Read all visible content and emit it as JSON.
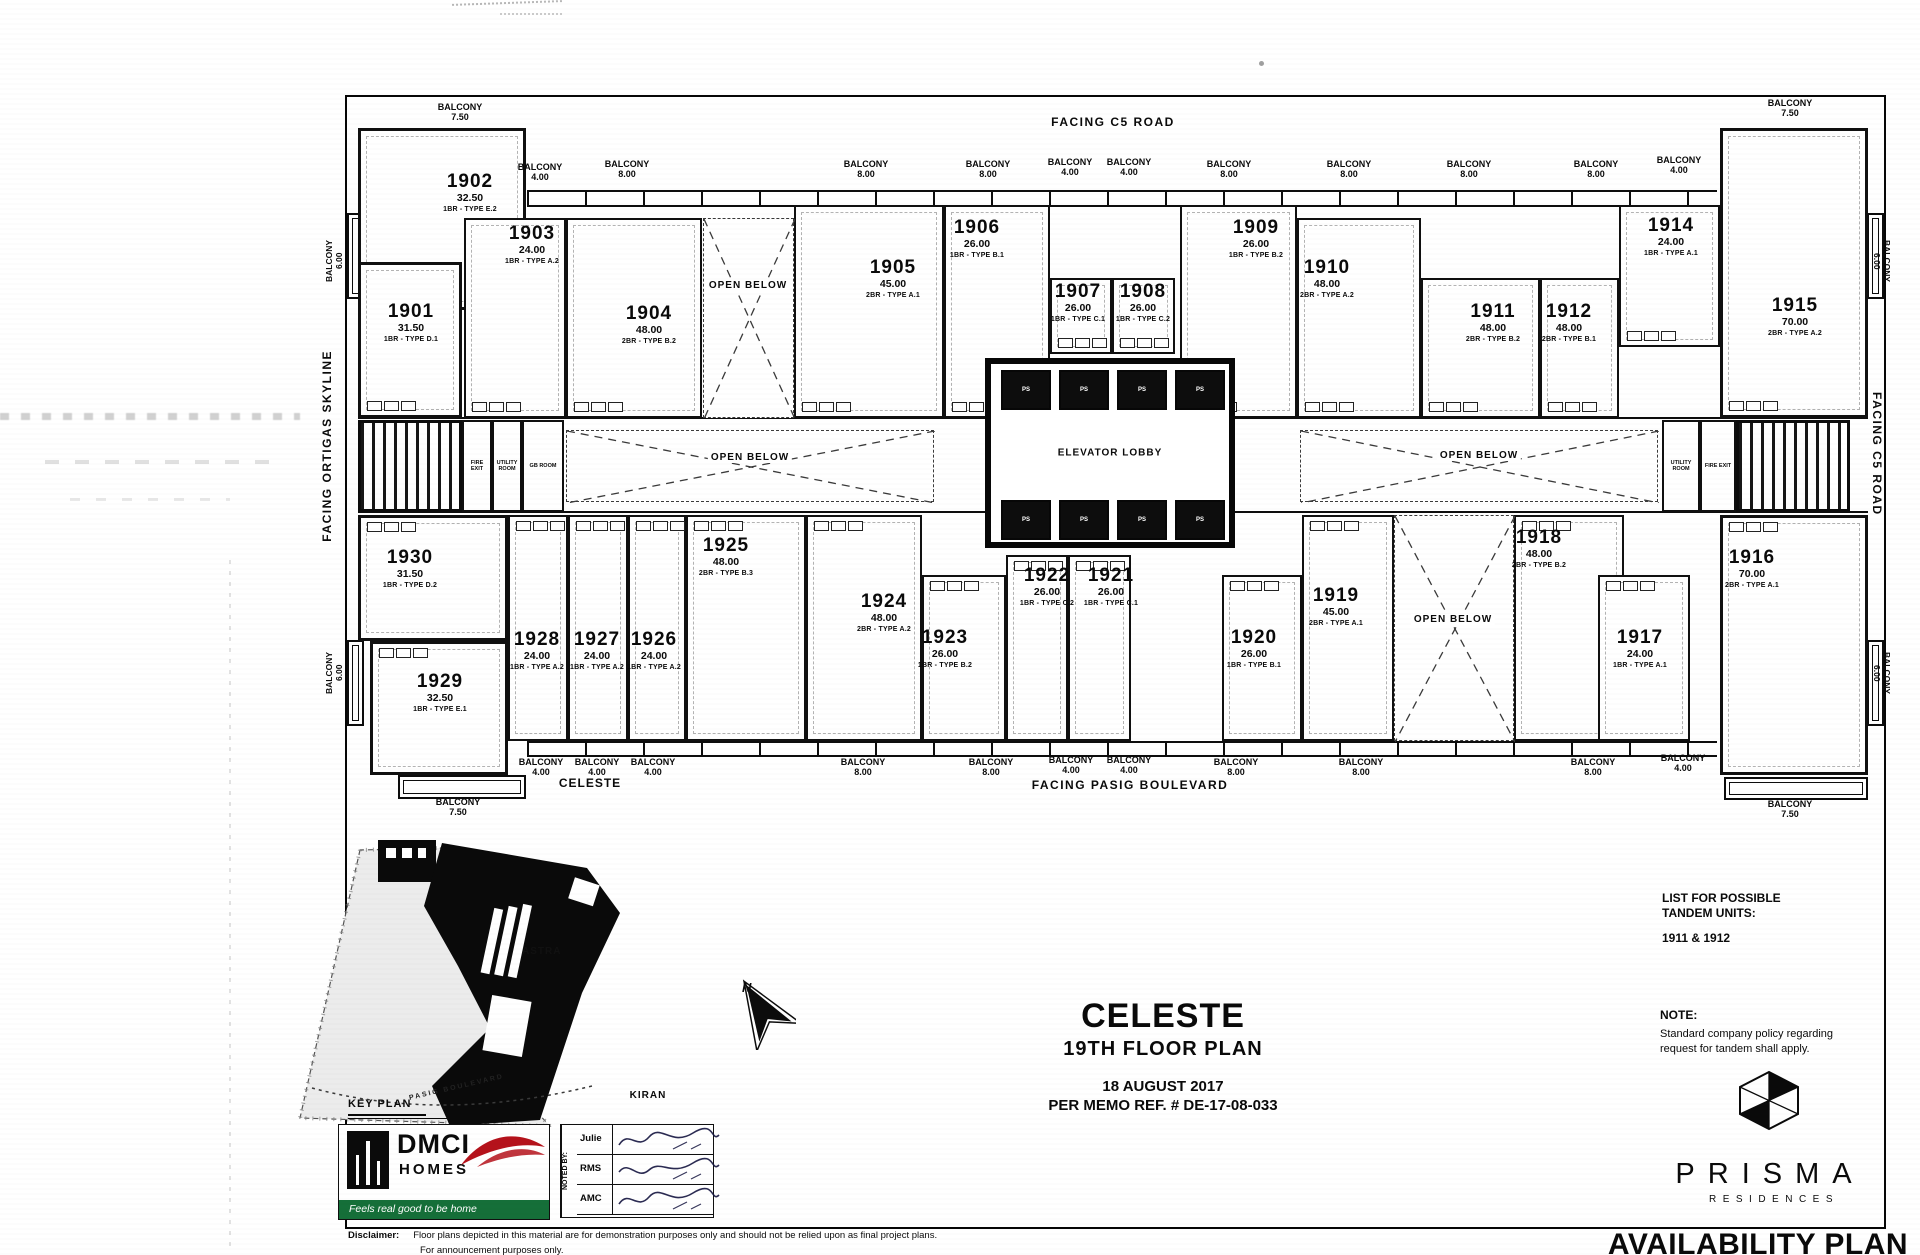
{
  "plan": {
    "facing_top": "FACING C5 ROAD",
    "facing_left": "FACING ORTIGAS SKYLINE",
    "facing_right": "FACING C5 ROAD",
    "facing_bottom": "FACING PASIG BOULEVARD",
    "elevator_label": "ELEVATOR LOBBY",
    "open_below_label": "OPEN BELOW",
    "balcony_word": "BALCONY",
    "car_label": "PS"
  },
  "units": [
    {
      "n": "1902",
      "a": "32.50",
      "t": "1BR - TYPE E.2",
      "x": 358,
      "y": 128,
      "w": 168,
      "h": 182,
      "lx": 470,
      "ly": 172,
      "corner": true
    },
    {
      "n": "1901",
      "a": "31.50",
      "t": "1BR - TYPE D.1",
      "x": 358,
      "y": 262,
      "w": 104,
      "h": 156,
      "lx": 411,
      "ly": 302,
      "corner": true
    },
    {
      "n": "1903",
      "a": "24.00",
      "t": "1BR - TYPE A.2",
      "x": 464,
      "y": 218,
      "w": 102,
      "h": 200,
      "lx": 532,
      "ly": 224
    },
    {
      "n": "1904",
      "a": "48.00",
      "t": "2BR - TYPE B.2",
      "x": 566,
      "y": 218,
      "w": 136,
      "h": 200,
      "lx": 649,
      "ly": 304
    },
    {
      "n": "1905",
      "a": "45.00",
      "t": "2BR - TYPE A.1",
      "x": 794,
      "y": 205,
      "w": 150,
      "h": 213,
      "lx": 893,
      "ly": 258
    },
    {
      "n": "1906",
      "a": "26.00",
      "t": "1BR - TYPE B.1",
      "x": 944,
      "y": 205,
      "w": 106,
      "h": 213,
      "lx": 977,
      "ly": 218
    },
    {
      "n": "1907",
      "a": "26.00",
      "t": "1BR - TYPE C.1",
      "x": 1050,
      "y": 278,
      "w": 62,
      "h": 76,
      "lx": 1078,
      "ly": 282
    },
    {
      "n": "1908",
      "a": "26.00",
      "t": "1BR - TYPE C.2",
      "x": 1112,
      "y": 278,
      "w": 63,
      "h": 76,
      "lx": 1143,
      "ly": 282
    },
    {
      "n": "1909",
      "a": "26.00",
      "t": "1BR - TYPE B.2",
      "x": 1180,
      "y": 205,
      "w": 117,
      "h": 213,
      "lx": 1256,
      "ly": 218
    },
    {
      "n": "1910",
      "a": "48.00",
      "t": "2BR - TYPE A.2",
      "x": 1297,
      "y": 218,
      "w": 124,
      "h": 200,
      "lx": 1327,
      "ly": 258
    },
    {
      "n": "1911",
      "a": "48.00",
      "t": "2BR - TYPE B.2",
      "x": 1421,
      "y": 278,
      "w": 119,
      "h": 140,
      "lx": 1493,
      "ly": 302
    },
    {
      "n": "1912",
      "a": "48.00",
      "t": "2BR - TYPE B.1",
      "x": 1540,
      "y": 278,
      "w": 79,
      "h": 140,
      "lx": 1569,
      "ly": 302
    },
    {
      "n": "1914",
      "a": "24.00",
      "t": "1BR - TYPE A.1",
      "x": 1619,
      "y": 205,
      "w": 101,
      "h": 142,
      "lx": 1671,
      "ly": 216
    },
    {
      "n": "1915",
      "a": "70.00",
      "t": "2BR - TYPE A.2",
      "x": 1720,
      "y": 128,
      "w": 148,
      "h": 290,
      "lx": 1795,
      "ly": 296,
      "corner": true
    },
    {
      "n": "1930",
      "a": "31.50",
      "t": "1BR - TYPE D.2",
      "x": 358,
      "y": 515,
      "w": 150,
      "h": 126,
      "lx": 410,
      "ly": 548,
      "corner": true
    },
    {
      "n": "1929",
      "a": "32.50",
      "t": "1BR - TYPE E.1",
      "x": 370,
      "y": 641,
      "w": 138,
      "h": 134,
      "lx": 440,
      "ly": 672,
      "corner": true
    },
    {
      "n": "1928",
      "a": "24.00",
      "t": "1BR - TYPE A.2",
      "x": 508,
      "y": 515,
      "w": 60,
      "h": 226,
      "lx": 537,
      "ly": 630
    },
    {
      "n": "1927",
      "a": "24.00",
      "t": "1BR - TYPE A.2",
      "x": 568,
      "y": 515,
      "w": 60,
      "h": 226,
      "lx": 597,
      "ly": 630
    },
    {
      "n": "1926",
      "a": "24.00",
      "t": "1BR - TYPE A.2",
      "x": 628,
      "y": 515,
      "w": 58,
      "h": 226,
      "lx": 654,
      "ly": 630
    },
    {
      "n": "1925",
      "a": "48.00",
      "t": "2BR - TYPE B.3",
      "x": 686,
      "y": 515,
      "w": 120,
      "h": 226,
      "lx": 726,
      "ly": 536
    },
    {
      "n": "1924",
      "a": "48.00",
      "t": "2BR - TYPE A.2",
      "x": 806,
      "y": 515,
      "w": 116,
      "h": 226,
      "lx": 884,
      "ly": 592
    },
    {
      "n": "1923",
      "a": "26.00",
      "t": "1BR - TYPE B.2",
      "x": 922,
      "y": 575,
      "w": 84,
      "h": 166,
      "lx": 945,
      "ly": 628
    },
    {
      "n": "1922",
      "a": "26.00",
      "t": "1BR - TYPE C.2",
      "x": 1006,
      "y": 555,
      "w": 62,
      "h": 186,
      "lx": 1047,
      "ly": 566
    },
    {
      "n": "1921",
      "a": "26.00",
      "t": "1BR - TYPE C.1",
      "x": 1068,
      "y": 555,
      "w": 63,
      "h": 186,
      "lx": 1111,
      "ly": 566
    },
    {
      "n": "1920",
      "a": "26.00",
      "t": "1BR - TYPE B.1",
      "x": 1222,
      "y": 575,
      "w": 80,
      "h": 166,
      "lx": 1254,
      "ly": 628
    },
    {
      "n": "1919",
      "a": "45.00",
      "t": "2BR - TYPE A.1",
      "x": 1302,
      "y": 515,
      "w": 92,
      "h": 226,
      "lx": 1336,
      "ly": 586
    },
    {
      "n": "1918",
      "a": "48.00",
      "t": "2BR - TYPE B.2",
      "x": 1514,
      "y": 515,
      "w": 110,
      "h": 226,
      "lx": 1539,
      "ly": 528
    },
    {
      "n": "1917",
      "a": "24.00",
      "t": "1BR - TYPE A.1",
      "x": 1598,
      "y": 575,
      "w": 92,
      "h": 166,
      "lx": 1640,
      "ly": 628
    },
    {
      "n": "1916",
      "a": "70.00",
      "t": "2BR - TYPE A.1",
      "x": 1720,
      "y": 515,
      "w": 148,
      "h": 260,
      "lx": 1752,
      "ly": 548,
      "corner": true
    }
  ],
  "open_below_areas": [
    {
      "x": 703,
      "y": 218,
      "w": 91,
      "h": 200,
      "lx": 748,
      "ly": 280
    },
    {
      "x": 1394,
      "y": 515,
      "w": 120,
      "h": 226,
      "lx": 1453,
      "ly": 614
    },
    {
      "x": 566,
      "y": 430,
      "w": 368,
      "h": 72,
      "lx": 750,
      "ly": 452
    },
    {
      "x": 1300,
      "y": 430,
      "w": 358,
      "h": 72,
      "lx": 1479,
      "ly": 450
    }
  ],
  "corridor_rooms": [
    {
      "label": "FIRE EXIT",
      "x": 462,
      "y": 420,
      "w": 30,
      "h": 92
    },
    {
      "label": "UTILITY ROOM",
      "x": 492,
      "y": 420,
      "w": 30,
      "h": 92
    },
    {
      "label": "GB ROOM",
      "x": 522,
      "y": 420,
      "w": 42,
      "h": 92
    },
    {
      "label": "UTILITY ROOM",
      "x": 1662,
      "y": 420,
      "w": 38,
      "h": 92
    },
    {
      "label": "FIRE EXIT",
      "x": 1700,
      "y": 420,
      "w": 36,
      "h": 92
    }
  ],
  "stairs": [
    {
      "x": 358,
      "y": 420,
      "w": 104,
      "h": 92
    },
    {
      "x": 1736,
      "y": 420,
      "w": 114,
      "h": 92
    }
  ],
  "elevator": {
    "x": 985,
    "y": 358,
    "w": 250,
    "h": 190,
    "cars": 8
  },
  "balconies_top": [
    {
      "x": 460,
      "y": 102,
      "v": "7.50"
    },
    {
      "x": 540,
      "y": 162,
      "v": "4.00"
    },
    {
      "x": 627,
      "y": 159,
      "v": "8.00"
    },
    {
      "x": 866,
      "y": 159,
      "v": "8.00"
    },
    {
      "x": 988,
      "y": 159,
      "v": "8.00"
    },
    {
      "x": 1070,
      "y": 157,
      "v": "4.00"
    },
    {
      "x": 1129,
      "y": 157,
      "v": "4.00"
    },
    {
      "x": 1229,
      "y": 159,
      "v": "8.00"
    },
    {
      "x": 1349,
      "y": 159,
      "v": "8.00"
    },
    {
      "x": 1469,
      "y": 159,
      "v": "8.00"
    },
    {
      "x": 1596,
      "y": 159,
      "v": "8.00"
    },
    {
      "x": 1679,
      "y": 155,
      "v": "4.00"
    },
    {
      "x": 1790,
      "y": 98,
      "v": "7.50"
    }
  ],
  "balconies_bottom": [
    {
      "x": 458,
      "y": 797,
      "v": "7.50"
    },
    {
      "x": 541,
      "y": 757,
      "v": "4.00"
    },
    {
      "x": 597,
      "y": 757,
      "v": "4.00"
    },
    {
      "x": 653,
      "y": 757,
      "v": "4.00"
    },
    {
      "x": 863,
      "y": 757,
      "v": "8.00"
    },
    {
      "x": 991,
      "y": 757,
      "v": "8.00"
    },
    {
      "x": 1071,
      "y": 755,
      "v": "4.00"
    },
    {
      "x": 1129,
      "y": 755,
      "v": "4.00"
    },
    {
      "x": 1236,
      "y": 757,
      "v": "8.00"
    },
    {
      "x": 1361,
      "y": 757,
      "v": "8.00"
    },
    {
      "x": 1593,
      "y": 757,
      "v": "8.00"
    },
    {
      "x": 1683,
      "y": 753,
      "v": "4.00"
    },
    {
      "x": 1790,
      "y": 799,
      "v": "7.50"
    }
  ],
  "balconies_side": [
    {
      "x": 324,
      "y": 240,
      "v": "6.00",
      "side": "left"
    },
    {
      "x": 324,
      "y": 652,
      "v": "6.00",
      "side": "left"
    },
    {
      "x": 1872,
      "y": 240,
      "v": "6.00",
      "side": "right"
    },
    {
      "x": 1872,
      "y": 652,
      "v": "6.00",
      "side": "right"
    }
  ],
  "tandem": {
    "line1": "LIST FOR POSSIBLE",
    "line2": "TANDEM UNITS:",
    "units": "1911 & 1912"
  },
  "note": {
    "label": "NOTE:",
    "line1": "Standard company policy regarding",
    "line2": "request for tandem shall apply."
  },
  "title": {
    "project": "CELESTE",
    "floor": "19TH FLOOR PLAN",
    "date": "18 AUGUST 2017",
    "memo": "PER MEMO REF. # DE-17-08-033"
  },
  "key_plan": {
    "label": "KEY PLAN",
    "celeste": "CELESTE",
    "astra": "ASTRA",
    "kiran": "KIRAN",
    "road": "PASIG BOULEVARD",
    "north": "N"
  },
  "branding": {
    "dmci": "DMCI",
    "homes": "HOMES",
    "tagline": "Feels real good to be home",
    "prisma": "PRISMA",
    "residences": "RESIDENCES",
    "availability": "AVAILABILITY PLAN"
  },
  "noted_by": {
    "header": "NOTED BY:",
    "rows": [
      "Julie",
      "RMS",
      "AMC"
    ]
  },
  "disclaimer": {
    "label": "Disclaimer:",
    "text": "Floor plans depicted in this material are for demonstration purposes only and should not be relied upon as final project plans.",
    "line2": "For announcement purposes only."
  }
}
